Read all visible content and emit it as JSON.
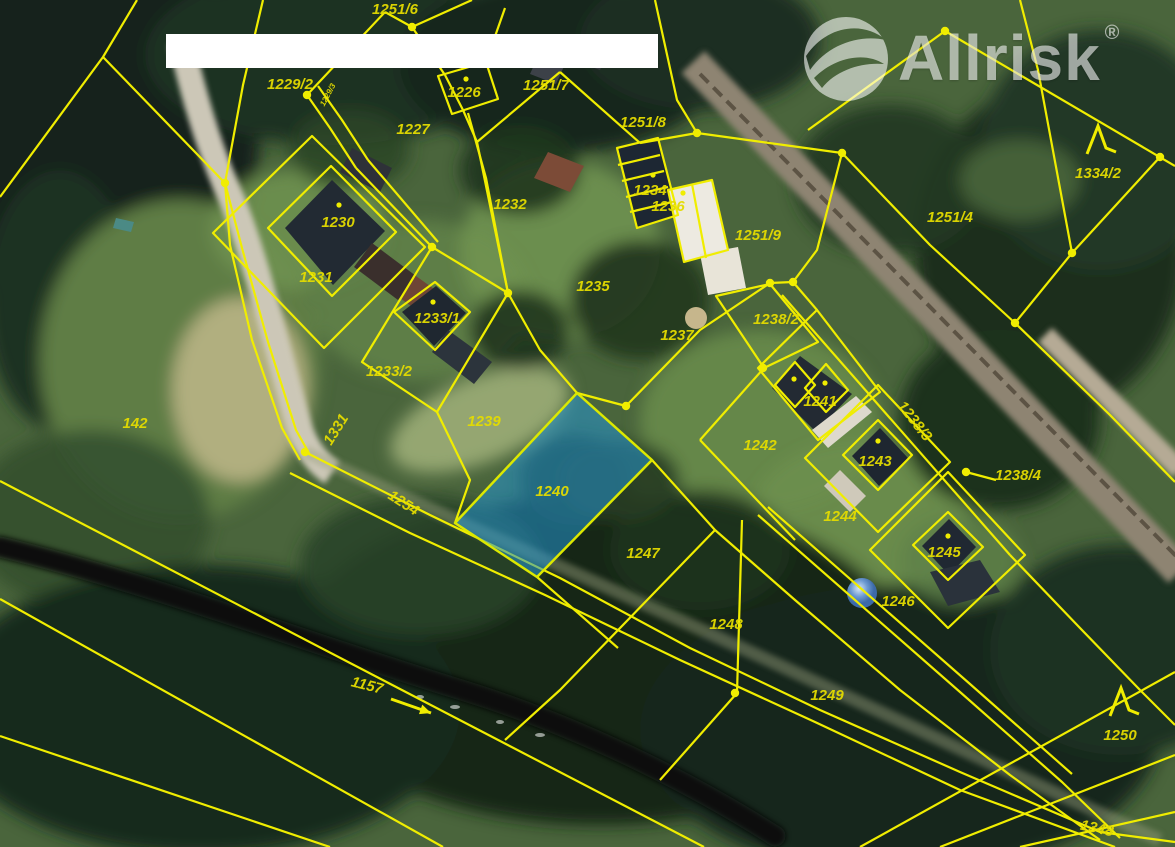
{
  "watermark": {
    "brand": "Allrisk",
    "registered": "®"
  },
  "map": {
    "highlighted_parcel": "1240",
    "highlight_color": "#2596d2",
    "highlight_border_color": "#dce800",
    "line_color": "#f0ed00",
    "label_color": "#e4dc00",
    "parcel_labels": [
      {
        "id": "1251/6",
        "x": 395,
        "y": 14
      },
      {
        "id": "1229/2",
        "x": 290,
        "y": 89
      },
      {
        "id": "1229/3",
        "x": 330,
        "y": 96,
        "rot": -62,
        "size": 8
      },
      {
        "id": "1226",
        "x": 464,
        "y": 97
      },
      {
        "id": "1227",
        "x": 413,
        "y": 134
      },
      {
        "id": "1251/7",
        "x": 546,
        "y": 90
      },
      {
        "id": "1251/8",
        "x": 643,
        "y": 127
      },
      {
        "id": "1334/2",
        "x": 1098,
        "y": 178
      },
      {
        "id": "1251/4",
        "x": 950,
        "y": 222
      },
      {
        "id": "1230",
        "x": 338,
        "y": 227
      },
      {
        "id": "1231",
        "x": 316,
        "y": 282
      },
      {
        "id": "1232",
        "x": 510,
        "y": 209
      },
      {
        "id": "1234",
        "x": 650,
        "y": 195
      },
      {
        "id": "1236",
        "x": 668,
        "y": 211
      },
      {
        "id": "1235",
        "x": 593,
        "y": 291
      },
      {
        "id": "1237",
        "x": 677,
        "y": 340
      },
      {
        "id": "1251/9",
        "x": 758,
        "y": 240
      },
      {
        "id": "1238/2",
        "x": 776,
        "y": 324
      },
      {
        "id": "1233/1",
        "x": 437,
        "y": 323
      },
      {
        "id": "1233/2",
        "x": 389,
        "y": 376
      },
      {
        "id": "1239",
        "x": 484,
        "y": 426
      },
      {
        "id": "1240",
        "x": 552,
        "y": 496
      },
      {
        "id": "1241",
        "x": 820,
        "y": 406
      },
      {
        "id": "1242",
        "x": 760,
        "y": 450
      },
      {
        "id": "1238/3",
        "x": 911,
        "y": 424,
        "rot": 52
      },
      {
        "id": "1243",
        "x": 875,
        "y": 466
      },
      {
        "id": "1238/4",
        "x": 1018,
        "y": 480
      },
      {
        "id": "1244",
        "x": 840,
        "y": 521
      },
      {
        "id": "1245",
        "x": 944,
        "y": 557
      },
      {
        "id": "1246",
        "x": 898,
        "y": 606
      },
      {
        "id": "1247",
        "x": 643,
        "y": 558
      },
      {
        "id": "1248",
        "x": 726,
        "y": 629
      },
      {
        "id": "1249",
        "x": 827,
        "y": 700
      },
      {
        "id": "1250",
        "x": 1120,
        "y": 740
      },
      {
        "id": "1348",
        "x": 1096,
        "y": 833,
        "rot": 12
      },
      {
        "id": "142",
        "x": 135,
        "y": 428
      },
      {
        "id": "1331",
        "x": 340,
        "y": 432,
        "rot": -58
      },
      {
        "id": "1254",
        "x": 401,
        "y": 507,
        "rot": 33
      },
      {
        "id": "1157",
        "x": 366,
        "y": 690,
        "rot": 14
      }
    ],
    "vertex_dots": [
      {
        "x": 412,
        "y": 27
      },
      {
        "x": 307,
        "y": 95
      },
      {
        "x": 225,
        "y": 183
      },
      {
        "x": 432,
        "y": 247
      },
      {
        "x": 508,
        "y": 293
      },
      {
        "x": 697,
        "y": 133
      },
      {
        "x": 842,
        "y": 153
      },
      {
        "x": 945,
        "y": 31
      },
      {
        "x": 1160,
        "y": 157
      },
      {
        "x": 1072,
        "y": 253
      },
      {
        "x": 770,
        "y": 283
      },
      {
        "x": 793,
        "y": 282
      },
      {
        "x": 1015,
        "y": 323
      },
      {
        "x": 626,
        "y": 406
      },
      {
        "x": 966,
        "y": 472
      },
      {
        "x": 305,
        "y": 452
      },
      {
        "x": 735,
        "y": 693
      },
      {
        "x": 763,
        "y": 368
      }
    ],
    "house_dots": [
      {
        "x": 466,
        "y": 79
      },
      {
        "x": 339,
        "y": 205
      },
      {
        "x": 433,
        "y": 302
      },
      {
        "x": 653,
        "y": 175
      },
      {
        "x": 683,
        "y": 193
      },
      {
        "x": 794,
        "y": 379
      },
      {
        "x": 825,
        "y": 383
      },
      {
        "x": 878,
        "y": 441
      },
      {
        "x": 948,
        "y": 536
      }
    ],
    "forest_symbols": [
      {
        "x": 1098,
        "y": 140
      },
      {
        "x": 1121,
        "y": 702
      }
    ],
    "flow_arrow": {
      "x1": 391,
      "y1": 699,
      "x2": 431,
      "y2": 713
    }
  }
}
